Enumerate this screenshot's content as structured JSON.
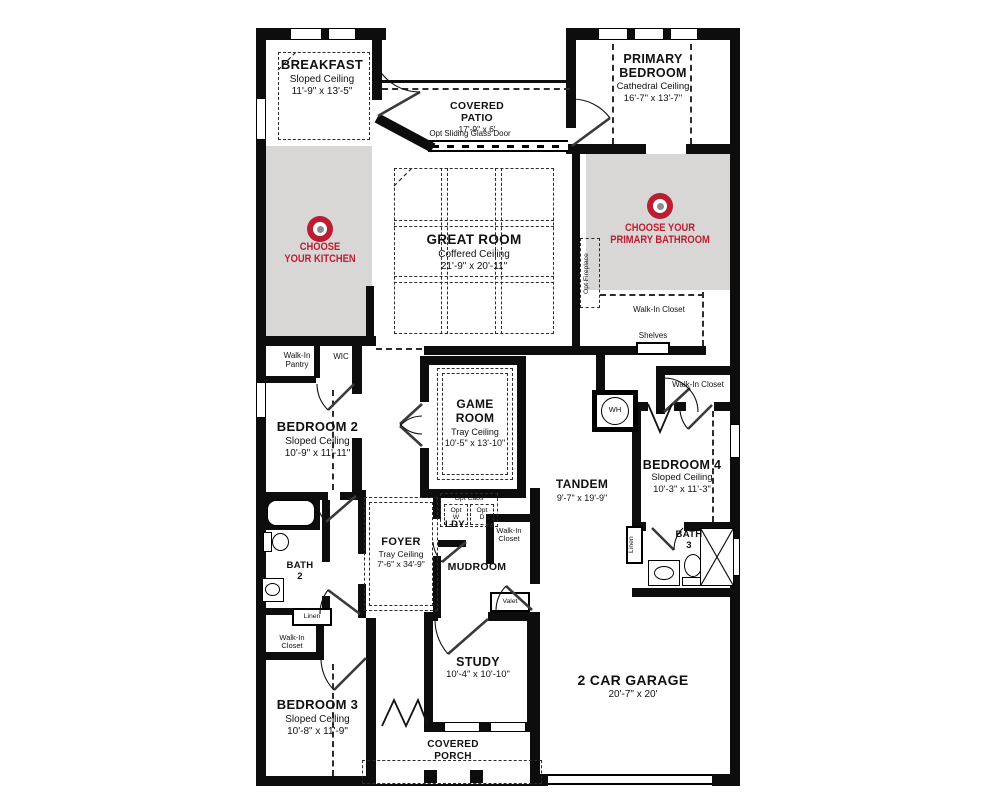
{
  "colors": {
    "accent": "#b91e32",
    "shade": "#d9d6d6",
    "wall": "#0d0d0d",
    "background": "#ffffff"
  },
  "rooms": {
    "breakfast": {
      "name": "BREAKFAST",
      "ceiling": "Sloped Ceiling",
      "dims": "11'-9\" x 13'-5\""
    },
    "covered_patio": {
      "name": "COVERED PATIO",
      "dims": "17'-9\" x 6'"
    },
    "primary_bedroom": {
      "name": "PRIMARY BEDROOM",
      "ceiling": "Cathedral Ceiling",
      "dims": "16'-7\" x 13'-7\""
    },
    "great_room": {
      "name": "GREAT ROOM",
      "ceiling": "Coffered Ceiling",
      "dims": "21'-9\" x 20'-11\""
    },
    "game_room": {
      "name": "GAME ROOM",
      "ceiling": "Tray Ceiling",
      "dims": "10'-5\" x 13'-10\""
    },
    "bedroom_2": {
      "name": "BEDROOM 2",
      "ceiling": "Sloped Ceiling",
      "dims": "10'-9\" x 11'-11\""
    },
    "bedroom_3": {
      "name": "BEDROOM 3",
      "ceiling": "Sloped Ceiling",
      "dims": "10'-8\" x 11'-9\""
    },
    "bedroom_4": {
      "name": "BEDROOM 4",
      "ceiling": "Sloped Ceiling",
      "dims": "10'-3\" x 11'-3\""
    },
    "tandem": {
      "name": "TANDEM",
      "dims": "9'-7\" x 19'-9\""
    },
    "foyer": {
      "name": "FOYER",
      "ceiling": "Tray Ceiling",
      "dims": "7'-6\" x 34'-9\""
    },
    "study": {
      "name": "STUDY",
      "dims": "10'-4\" x 10'-10\""
    },
    "garage": {
      "name": "2 CAR GARAGE",
      "dims": "20'-7\" x 20'"
    },
    "covered_porch": {
      "line1": "COVERED",
      "line2": "PORCH"
    },
    "mudroom": {
      "name": "MUDROOM"
    },
    "laundry": {
      "name": "LDY"
    },
    "bath_2": {
      "name": "BATH",
      "number": "2"
    },
    "bath_3": {
      "name": "BATH",
      "number": "3"
    }
  },
  "callouts": {
    "kitchen": {
      "line1": "CHOOSE",
      "line2": "YOUR KITCHEN"
    },
    "primary_bathroom": {
      "line1": "CHOOSE YOUR",
      "line2": "PRIMARY BATHROOM"
    }
  },
  "labels": {
    "walk_in_closet": "Walk-In Closet",
    "walk_in_pantry": "Walk-In Pantry",
    "wic": "WIC",
    "shelves": "Shelves",
    "linen": "Linen",
    "valet": "Valet",
    "water_heater": "WH",
    "opt_fireplace": "Opt Fireplace",
    "opt_sliding_glass_door": "Opt Sliding Glass Door",
    "opt_cabs": "Opt Cabs",
    "opt": "Opt",
    "washer": "W",
    "dryer": "D"
  }
}
